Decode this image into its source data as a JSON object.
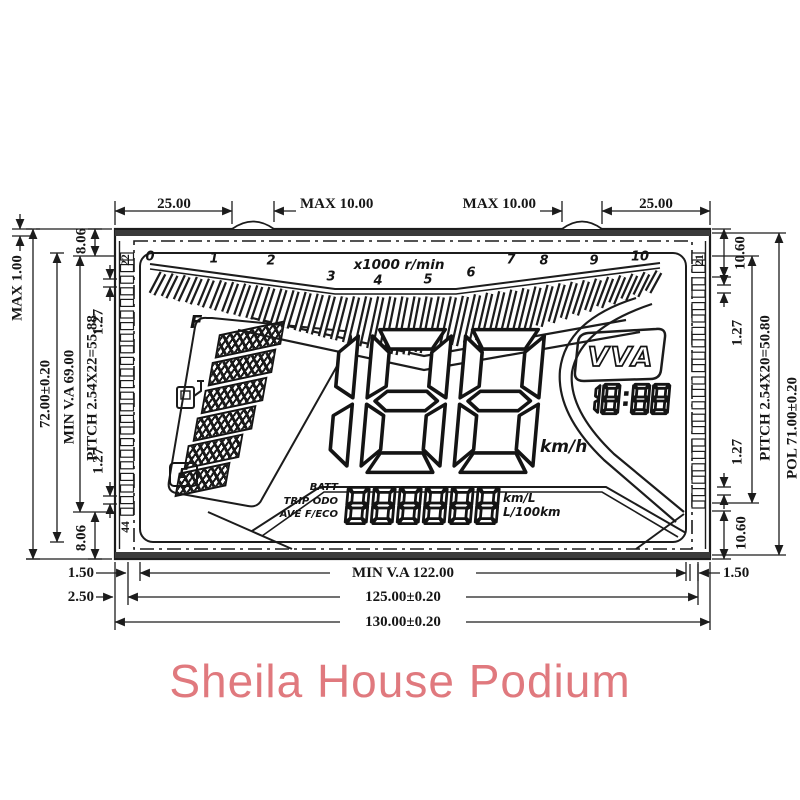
{
  "colors": {
    "line": "#1c1c1c",
    "brand_pink": "#e0797e"
  },
  "dims": {
    "top_left": "25.00",
    "top_tab_left": "MAX 10.00",
    "top_tab_right": "MAX 10.00",
    "top_right": "25.00",
    "left_max": "MAX 1.00",
    "left_height": "72.00±0.20",
    "left_va": "MIN V.A 69.00",
    "left_pitch": "PITCH 2.54X22=55.88",
    "left_gap_top": "8.06",
    "left_half_top": "1.27",
    "left_half_bottom": "1.27",
    "left_gap_bottom": "8.06",
    "right_gap_top": "10.60",
    "right_half_top": "1.27",
    "right_pitch": "PITCH 2.54X20=50.80",
    "right_pol": "POL 71.00±0.20",
    "right_half_bottom": "1.27",
    "right_gap_bottom": "10.60",
    "right_inset": "1.50",
    "bottom_va": "MIN V.A 122.00",
    "bottom_pol": "125.00±0.20",
    "bottom_outer": "130.00±0.20",
    "bottom_left_inset1": "1.50",
    "bottom_left_inset2": "2.50"
  },
  "pins": {
    "top_left": "22",
    "bottom_left": "44",
    "top_right": "21"
  },
  "lcd": {
    "tach_scale": [
      "0",
      "1",
      "2",
      "3",
      "4",
      "5",
      "6",
      "7",
      "8",
      "9",
      "10"
    ],
    "tach_unit": "x1000 r/min",
    "fuel_full": "F",
    "fuel_empty": "E",
    "speed_value": "188",
    "speed_unit": "km/h",
    "vva": "VVA",
    "clock": "18:88",
    "info_labels": [
      "BATT",
      "TRIP ODO",
      "AVE F/ECO"
    ],
    "odo_value": "888888",
    "unit_kml": "km/L",
    "unit_l100": "L/100km"
  },
  "footer": {
    "brand": "Sheila House Podium"
  }
}
